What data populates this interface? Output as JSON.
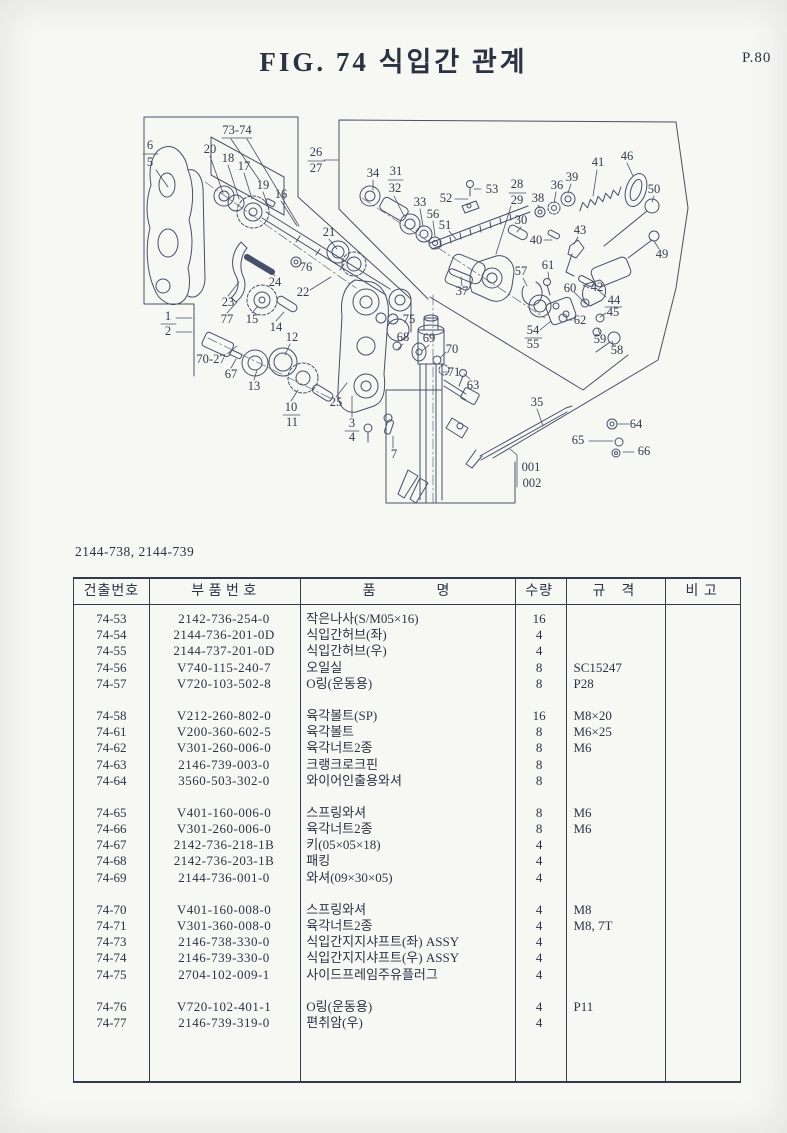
{
  "page": {
    "title": "FIG. 74  식입간 관계",
    "page_no": "P.80",
    "subtitle": "2144-738, 2144-739"
  },
  "colors": {
    "ink": "#333b4d",
    "paper": "#f7f7f4"
  },
  "table": {
    "headers": [
      "건출번호",
      "부 품 번 호",
      "품    명",
      "수량",
      "규 격",
      "비 고"
    ],
    "groups": [
      [
        [
          "74-53",
          "2142-736-254-0",
          "작은나사(S/M05×16)",
          "16",
          "",
          ""
        ],
        [
          "74-54",
          "2144-736-201-0D",
          "식입간허브(좌)",
          "4",
          "",
          ""
        ],
        [
          "74-55",
          "2144-737-201-0D",
          "식입간허브(우)",
          "4",
          "",
          ""
        ],
        [
          "74-56",
          "V740-115-240-7",
          "오일실",
          "8",
          "SC15247",
          ""
        ],
        [
          "74-57",
          "V720-103-502-8",
          "O링(운동용)",
          "8",
          "P28",
          ""
        ]
      ],
      [
        [
          "74-58",
          "V212-260-802-0",
          "육각볼트(SP)",
          "16",
          "M8×20",
          ""
        ],
        [
          "74-61",
          "V200-360-602-5",
          "육각볼트",
          "8",
          "M6×25",
          ""
        ],
        [
          "74-62",
          "V301-260-006-0",
          "육각너트2종",
          "8",
          "M6",
          ""
        ],
        [
          "74-63",
          "2146-739-003-0",
          "크랭크로크핀",
          "8",
          "",
          ""
        ],
        [
          "74-64",
          "3560-503-302-0",
          "와이어인출용와셔",
          "8",
          "",
          ""
        ]
      ],
      [
        [
          "74-65",
          "V401-160-006-0",
          "스프링와셔",
          "8",
          "M6",
          ""
        ],
        [
          "74-66",
          "V301-260-006-0",
          "육각너트2종",
          "8",
          "M6",
          ""
        ],
        [
          "74-67",
          "2142-736-218-1B",
          "키(05×05×18)",
          "4",
          "",
          ""
        ],
        [
          "74-68",
          "2142-736-203-1B",
          "패킹",
          "4",
          "",
          ""
        ],
        [
          "74-69",
          "2144-736-001-0",
          "와셔(09×30×05)",
          "4",
          "",
          ""
        ]
      ],
      [
        [
          "74-70",
          "V401-160-008-0",
          "스프링와셔",
          "4",
          "M8",
          ""
        ],
        [
          "74-71",
          "V301-360-008-0",
          "육각너트2종",
          "4",
          "M8, 7T",
          ""
        ],
        [
          "74-73",
          "2146-738-330-0",
          "식입간지지샤프트(좌) ASSY",
          "4",
          "",
          ""
        ],
        [
          "74-74",
          "2146-739-330-0",
          "식입간지지샤프트(우) ASSY",
          "4",
          "",
          ""
        ],
        [
          "74-75",
          "2704-102-009-1",
          "사이드프레임주유플러그",
          "4",
          "",
          ""
        ]
      ],
      [
        [
          "74-76",
          "V720-102-401-1",
          "O링(운동용)",
          "4",
          "P11",
          ""
        ],
        [
          "74-77",
          "2146-739-319-0",
          "편취암(우)",
          "4",
          "",
          ""
        ]
      ]
    ]
  },
  "diagram": {
    "labels": [
      {
        "t": "73-74",
        "x": 237,
        "y": 131
      },
      {
        "t": "6",
        "x": 150,
        "y": 146
      },
      {
        "t": "5",
        "x": 150,
        "y": 163
      },
      {
        "t": "20",
        "x": 210,
        "y": 150
      },
      {
        "t": "18",
        "x": 228,
        "y": 159
      },
      {
        "t": "17",
        "x": 244,
        "y": 167
      },
      {
        "t": "19",
        "x": 263,
        "y": 186
      },
      {
        "t": "16",
        "x": 281,
        "y": 195
      },
      {
        "t": "26",
        "x": 316,
        "y": 153
      },
      {
        "t": "27",
        "x": 316,
        "y": 169
      },
      {
        "t": "34",
        "x": 373,
        "y": 174
      },
      {
        "t": "31",
        "x": 396,
        "y": 172
      },
      {
        "t": "32",
        "x": 395,
        "y": 189
      },
      {
        "t": "33",
        "x": 420,
        "y": 203
      },
      {
        "t": "56",
        "x": 433,
        "y": 215
      },
      {
        "t": "51",
        "x": 445,
        "y": 226
      },
      {
        "t": "52",
        "x": 446,
        "y": 199
      },
      {
        "t": "53",
        "x": 492,
        "y": 190
      },
      {
        "t": "28",
        "x": 517,
        "y": 185
      },
      {
        "t": "29",
        "x": 517,
        "y": 201
      },
      {
        "t": "38",
        "x": 538,
        "y": 199
      },
      {
        "t": "36",
        "x": 557,
        "y": 186
      },
      {
        "t": "39",
        "x": 572,
        "y": 178
      },
      {
        "t": "41",
        "x": 598,
        "y": 163
      },
      {
        "t": "46",
        "x": 627,
        "y": 157
      },
      {
        "t": "50",
        "x": 654,
        "y": 190
      },
      {
        "t": "49",
        "x": 662,
        "y": 255
      },
      {
        "t": "30",
        "x": 521,
        "y": 221
      },
      {
        "t": "40",
        "x": 536,
        "y": 241
      },
      {
        "t": "43",
        "x": 580,
        "y": 231
      },
      {
        "t": "21",
        "x": 329,
        "y": 233
      },
      {
        "t": "76",
        "x": 306,
        "y": 268
      },
      {
        "t": "24",
        "x": 275,
        "y": 283
      },
      {
        "t": "22",
        "x": 303,
        "y": 293
      },
      {
        "t": "23",
        "x": 228,
        "y": 303
      },
      {
        "t": "77",
        "x": 227,
        "y": 320
      },
      {
        "t": "15",
        "x": 252,
        "y": 320
      },
      {
        "t": "14",
        "x": 276,
        "y": 328
      },
      {
        "t": "1",
        "x": 168,
        "y": 317
      },
      {
        "t": "2",
        "x": 168,
        "y": 332
      },
      {
        "t": "70-27",
        "x": 211,
        "y": 360
      },
      {
        "t": "67",
        "x": 231,
        "y": 375
      },
      {
        "t": "13",
        "x": 254,
        "y": 387
      },
      {
        "t": "12",
        "x": 292,
        "y": 338
      },
      {
        "t": "10",
        "x": 291,
        "y": 408
      },
      {
        "t": "11",
        "x": 292,
        "y": 423
      },
      {
        "t": "25",
        "x": 336,
        "y": 403
      },
      {
        "t": "3",
        "x": 352,
        "y": 424
      },
      {
        "t": "4",
        "x": 352,
        "y": 438
      },
      {
        "t": "7",
        "x": 394,
        "y": 455
      },
      {
        "t": "75",
        "x": 409,
        "y": 320
      },
      {
        "t": "68",
        "x": 403,
        "y": 338
      },
      {
        "t": "69",
        "x": 429,
        "y": 339
      },
      {
        "t": "70",
        "x": 452,
        "y": 350
      },
      {
        "t": "71",
        "x": 454,
        "y": 373
      },
      {
        "t": "63",
        "x": 473,
        "y": 386
      },
      {
        "t": "37",
        "x": 462,
        "y": 292
      },
      {
        "t": "57",
        "x": 521,
        "y": 272
      },
      {
        "t": "61",
        "x": 548,
        "y": 266
      },
      {
        "t": "60",
        "x": 570,
        "y": 289
      },
      {
        "t": "42",
        "x": 597,
        "y": 288
      },
      {
        "t": "44",
        "x": 614,
        "y": 301
      },
      {
        "t": "45",
        "x": 613,
        "y": 313
      },
      {
        "t": "62",
        "x": 580,
        "y": 321
      },
      {
        "t": "54",
        "x": 533,
        "y": 331
      },
      {
        "t": "55",
        "x": 533,
        "y": 345
      },
      {
        "t": "59",
        "x": 600,
        "y": 340
      },
      {
        "t": "58",
        "x": 617,
        "y": 351
      },
      {
        "t": "35",
        "x": 537,
        "y": 403
      },
      {
        "t": "64",
        "x": 636,
        "y": 425
      },
      {
        "t": "65",
        "x": 578,
        "y": 441
      },
      {
        "t": "66",
        "x": 644,
        "y": 452
      },
      {
        "t": "001",
        "x": 531,
        "y": 468
      },
      {
        "t": "002",
        "x": 532,
        "y": 484
      }
    ]
  }
}
